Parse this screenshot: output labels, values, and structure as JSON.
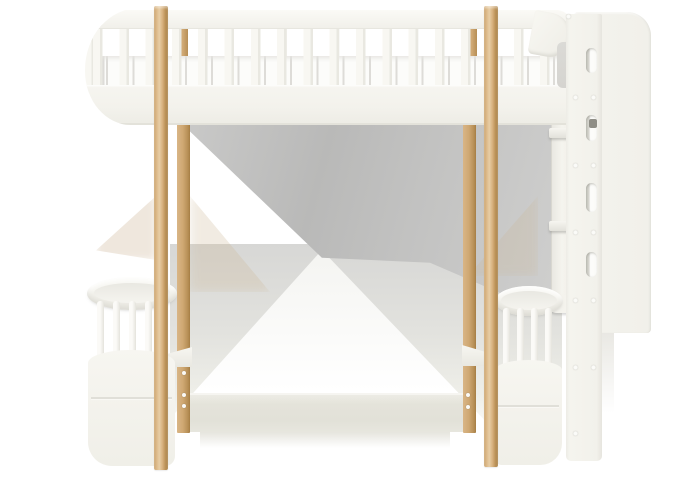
{
  "meta": {
    "kind": "product-photo",
    "subject": "children's loft bunk bed, white frame with oak wood posts",
    "background": "#ffffff",
    "width_px": 675,
    "height_px": 480
  },
  "scene": {
    "upper_bed": {
      "description": "elevated upper bunk with slatted safety guard rail, rounded left end and white mattress visible between slats",
      "guard_slat_count": 17
    },
    "posts": {
      "material": "oak",
      "front_count": 2,
      "rear_count": 2
    },
    "ladder_panel": {
      "position": "right",
      "description": "white side panel with rounded top corner, stadium-shaped climbing cutouts and paired screw caps",
      "cutout_count": 4,
      "step_count": 2,
      "screw_dot_rows": 6
    },
    "lower_end_sections": {
      "description": "rounded crib-style lower end sections with vertical spindles and solid curved bases",
      "left_spindle_count": 5,
      "right_spindle_count": 4
    },
    "lower_rail": {
      "description": "light beige lower bed side rail between rear posts"
    },
    "shading": {
      "description": "gray hourglass-shaped perspective shading beneath the upper bunk and above the floor"
    }
  },
  "palette": {
    "bg": "#ffffff",
    "frame_white": "#f4f3ed",
    "bright_white": "#fcfcfa",
    "band_white": "#f1f0ea",
    "rail_top": "#fbfaf6",
    "edge_line": "#dddcd4",
    "oak_light": "#e7cda5",
    "oak_mid": "#d4aa77",
    "oak_dark": "#a47c42",
    "oak_rear_light": "#d9b586",
    "oak_rear_mid": "#cfa873",
    "oak_rear_dark": "#a57d44",
    "shadow_dark": "#b9b9b8",
    "shadow_mid": "#c9c9c8",
    "shadow_light": "#dcdcd9",
    "floor_beige": "#e4e3da",
    "plate_gray": "#d5d4d0",
    "notch_gray": "#8f8e86"
  }
}
